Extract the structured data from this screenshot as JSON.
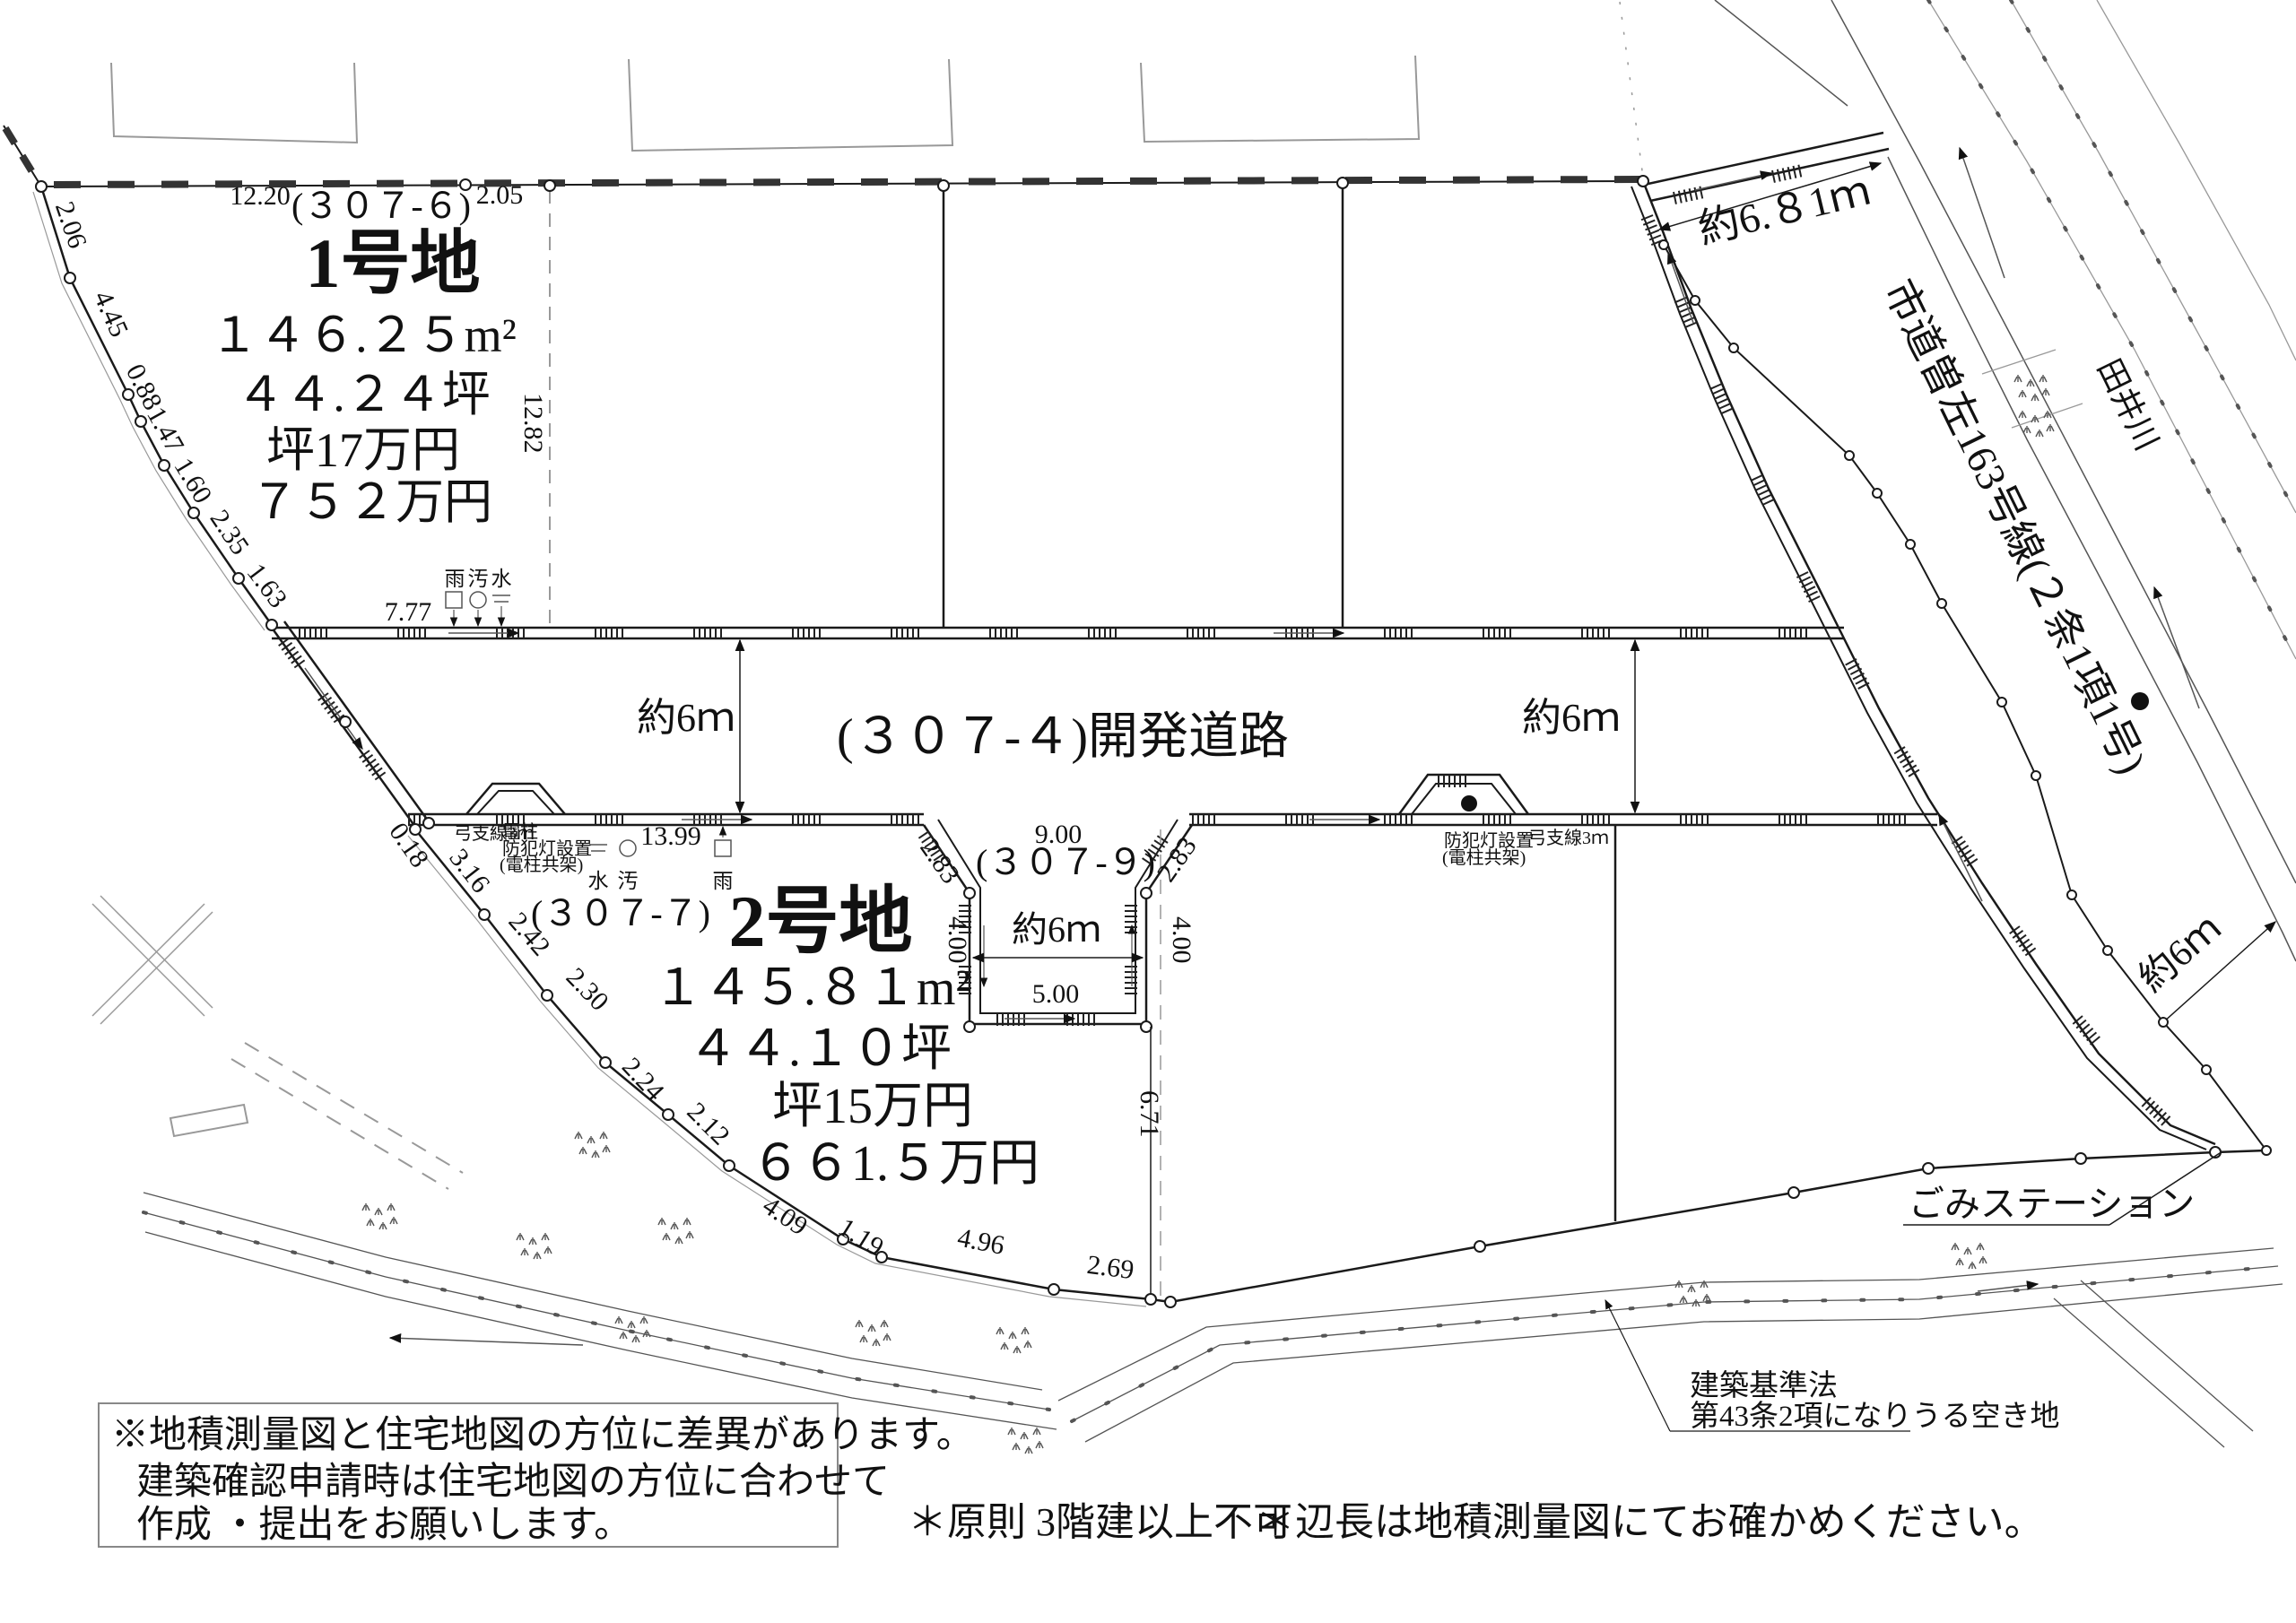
{
  "title": "分譲地区画図（地積測量図ベース）",
  "colors": {
    "ink": "#1a1a1a",
    "faint": "#999999",
    "background": "#ffffff"
  },
  "plot1": {
    "parcel": "(３０７-６)",
    "name": "1号地",
    "area_m2": "１４６.２５m²",
    "area_tsubo": "４４.２４坪",
    "unit_price": "坪17万円",
    "price": "７５２万円"
  },
  "plot2": {
    "parcel": "(３０７-７)",
    "name": "2号地",
    "area_m2": "１４５.８１m²",
    "area_tsubo": "４４.１０坪",
    "unit_price": "坪15万円",
    "price": "６６1.５万円"
  },
  "dev_road": {
    "label": "(３０７-４)開発道路",
    "width_left": "約6ｍ",
    "width_right": "約6ｍ"
  },
  "pocket": {
    "parcel": "(３０７-９)",
    "top": "9.00",
    "bottom": "5.00",
    "width": "約6ｍ",
    "side_left": "4.00",
    "side_right": "4.00",
    "diag_left": "2.83",
    "diag_right": "2.83",
    "depth": "6.71"
  },
  "city_road": {
    "name": "市道曽左163号線(２条1項1号)",
    "river": "田井川",
    "access": "約6.８1ｍ",
    "south_width": "約6ｍ"
  },
  "dims": {
    "top_a": "12.20",
    "top_b": "2.05",
    "w1": "2.06",
    "w2": "4.45",
    "w3": "0.88",
    "w4": "1.47",
    "w5": "1.60",
    "w6": "2.35",
    "w7": "1.63",
    "plot1_frontage": "7.77",
    "plot1_east": "12.82",
    "sw1": "0.18",
    "sw2": "3.16",
    "sw3": "2.42",
    "sw4": "2.30",
    "sw5": "2.24",
    "sw6": "2.12",
    "s1": "4.09",
    "s2": "1.19",
    "s3": "4.96",
    "s4": "2.69",
    "plot2_frontage": "13.99"
  },
  "utilities": {
    "rain": "雨",
    "sewer": "汚",
    "water": "水",
    "pole": "電柱",
    "lamp": "防犯灯設置",
    "shared": "(電柱共架)",
    "stay": "弓支線3ｍ"
  },
  "labels": {
    "garbage": "ごみステーション",
    "law1": "建築基準法",
    "law2": "第43条2項になりうる空き地"
  },
  "notes": {
    "line1": "※地積測量図と住宅地図の方位に差異があります。",
    "line2": "建築確認申請時は住宅地図の方位に合わせて",
    "line3": "作成 ・提出をお願いします。",
    "bottom1": "＊原則 3階建以上不可",
    "bottom2": "＊辺長は地積測量図にてお確かめください。"
  }
}
